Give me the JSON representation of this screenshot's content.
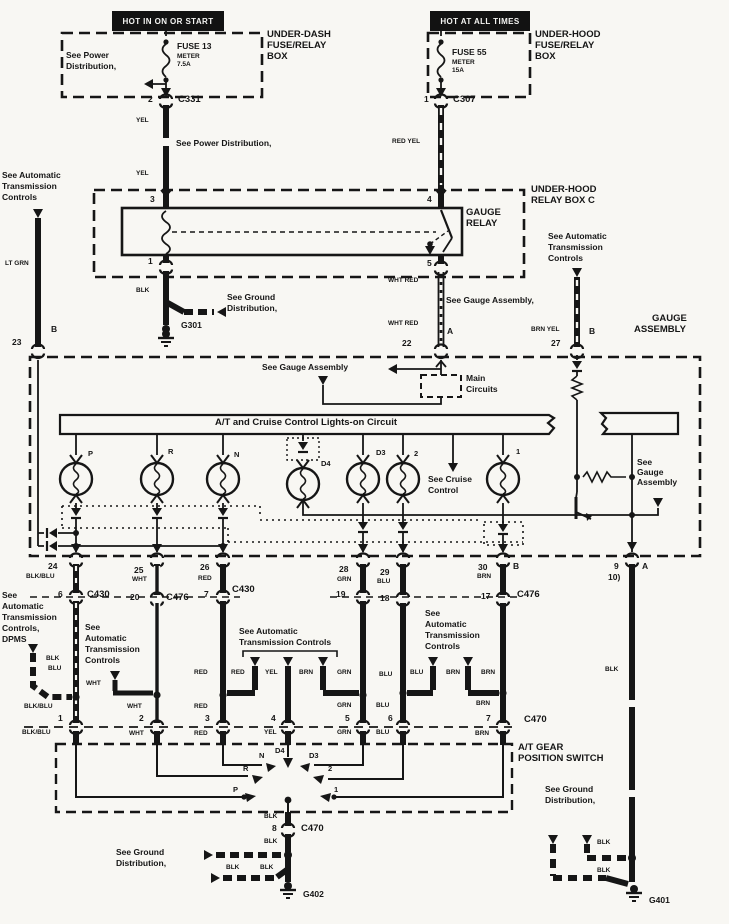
{
  "banners": {
    "hot_on_start": "HOT IN ON OR START",
    "hot_all_times": "HOT AT ALL TIMES"
  },
  "fuses": {
    "f13": {
      "name": "FUSE 13",
      "sub1": "METER",
      "sub2": "7.5A"
    },
    "f55": {
      "name": "FUSE 55",
      "sub1": "METER",
      "sub2": "15A"
    }
  },
  "boxes": {
    "under_dash": [
      "UNDER-DASH",
      "FUSE/RELAY",
      "BOX"
    ],
    "under_hood": [
      "UNDER-HOOD",
      "FUSE/RELAY",
      "BOX"
    ],
    "relay_box": [
      "UNDER-HOOD",
      "RELAY BOX C"
    ],
    "gauge_relay": [
      "GAUGE",
      "RELAY"
    ],
    "gauge_assembly": [
      "GAUGE",
      "ASSEMBLY"
    ],
    "main_circuits": [
      "Main",
      "Circuits"
    ],
    "gear_switch": [
      "A/T GEAR",
      "POSITION SWITCH"
    ]
  },
  "bar": {
    "label": "A/T and Cruise Control Lights-on Circuit"
  },
  "notes": {
    "power1": [
      "See Power",
      "Distribution,"
    ],
    "power2": "See Power Distribution,",
    "auto_tl": [
      "See Automatic",
      "Transmission",
      "Controls"
    ],
    "auto_tr": [
      "See Automatic",
      "Transmission",
      "Controls"
    ],
    "ground1": [
      "See Ground",
      "Distribution,"
    ],
    "gauge1": "See Gauge Assembly,",
    "gauge2": "See Gauge Assembly",
    "gauge3": [
      "See",
      "Gauge",
      "Assembly"
    ],
    "cruise": [
      "See Cruise",
      "Control"
    ],
    "dpms": [
      "See",
      "Automatic",
      "Transmission",
      "Controls,",
      "DPMS"
    ],
    "auto_b1": [
      "See",
      "Automatic",
      "Transmission",
      "Controls"
    ],
    "auto_b2": [
      "See Automatic",
      "Transmission Controls"
    ],
    "auto_b3": [
      "See",
      "Automatic",
      "Transmission",
      "Controls"
    ],
    "ground_bl": [
      "See Ground",
      "Distribution,"
    ],
    "ground_br": [
      "See Ground",
      "Distribution,"
    ]
  },
  "lamps": [
    "P",
    "R",
    "N",
    "D4",
    "D3",
    "2",
    "1"
  ],
  "positions": [
    "P",
    "R",
    "N",
    "D4",
    "D3",
    "2",
    "1"
  ],
  "connectors": {
    "c331": "C331",
    "c307": "C307",
    "c430_1": "C430",
    "c476_1": "C476",
    "c430_2": "C430",
    "c476_2": "C476",
    "c470_1": "C470",
    "c470_2": "C470"
  },
  "grounds": {
    "g301": "G301",
    "g402": "G402",
    "g401": "G401"
  },
  "pins": {
    "f13_out": "2",
    "f55_out": "1",
    "r3": "3",
    "r4": "4",
    "r1": "1",
    "r5": "5",
    "ga23": "23",
    "gaB1": "B",
    "ga22": "22",
    "gaA1": "A",
    "ga27": "27",
    "gaB2": "B",
    "ga24": "24",
    "ga25": "25",
    "ga26": "26",
    "ga28": "28",
    "ga29": "29",
    "ga30": "30",
    "gaB3": "B",
    "ga9": "9",
    "ga10": "10)",
    "gaA2": "A",
    "cp6": "6",
    "cp20": "20",
    "cp7": "7",
    "cp19": "19",
    "cp18": "18",
    "cp17": "17",
    "s1": "1",
    "s2": "2",
    "s3": "3",
    "s4": "4",
    "s5": "5",
    "s6": "6",
    "s7": "7",
    "s8": "8"
  },
  "wires": {
    "yel_a": "YEL",
    "yel_b": "YEL",
    "red_yel": "RED YEL",
    "blk_a": "BLK",
    "whtred_a": "WHT RED",
    "whtred_b": "WHT RED",
    "brn_yel": "BRN YEL",
    "lt_grn": "LT GRN",
    "blkblu_a": "BLK/BLU",
    "wht_a": "WHT",
    "red_a": "RED",
    "grn_a": "GRN",
    "blu_a": "BLU",
    "brn_a": "BRN",
    "blk_b": "BLK",
    "blu_b": "BLU",
    "wht_b": "WHT",
    "red_b": "RED",
    "red_c": "RED",
    "yel_c": "YEL",
    "brn_b": "BRN",
    "grn_b": "GRN",
    "blu_c": "BLU",
    "blu_d": "BLU",
    "brn_c": "BRN",
    "brn_d": "BRN",
    "blkblu_b": "BLK/BLU",
    "wht_c": "WHT",
    "red_d": "RED",
    "grn_c": "GRN",
    "blu_e": "BLU",
    "brn_e": "BRN",
    "blkblu_c": "BLK/BLU",
    "wht_d": "WHT",
    "red_e": "RED",
    "yel_d": "YEL",
    "grn_d": "GRN",
    "blu_f": "BLU",
    "brn_f": "BRN",
    "blk_c": "BLK",
    "blk_d": "BLK",
    "blk_e": "BLK",
    "blk_f": "BLK",
    "blk_g": "BLK",
    "blk_h": "BLK",
    "blk_i": "BLK"
  }
}
